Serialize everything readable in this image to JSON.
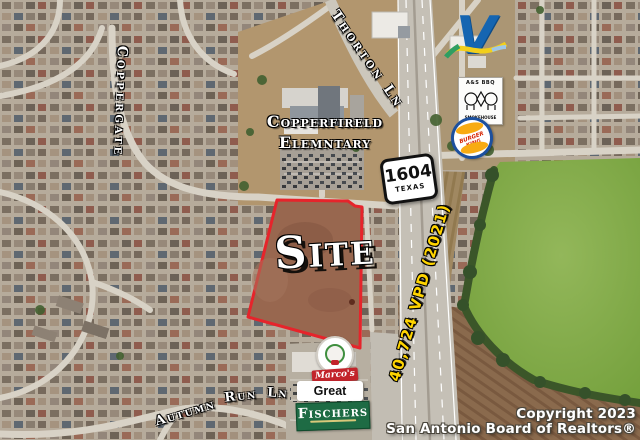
{
  "map": {
    "streets": {
      "thorton": "Thorton Ln",
      "coppergate": "Coppergate",
      "autumn_w1": "Autumn",
      "autumn_w2": "Run",
      "autumn_w3": "Ln"
    },
    "school": {
      "line1": "Copperfireld",
      "line2": "Elemntary"
    },
    "highway_shield": {
      "number": "1604",
      "state": "TEXAS"
    },
    "site": {
      "label": "Site",
      "outline_color": "#e6242b"
    },
    "traffic": {
      "label": "40,724 VPD (2021)",
      "color": "#ffd400"
    },
    "copyright": {
      "line1": "Copyright 2023",
      "line2": "San Antonio Board of Realtors®"
    }
  },
  "businesses": {
    "valero": {
      "letter": "V"
    },
    "bbq": {
      "top_text": "A&S BBQ",
      "bottom_text": "SMOKEHOUSE"
    },
    "burger_king": {
      "label": "BURGER KING"
    },
    "marcos": {
      "label": "Marco's"
    },
    "great_clips": {
      "label": "Great Clips"
    },
    "fischers": {
      "label": "Fischers"
    }
  }
}
